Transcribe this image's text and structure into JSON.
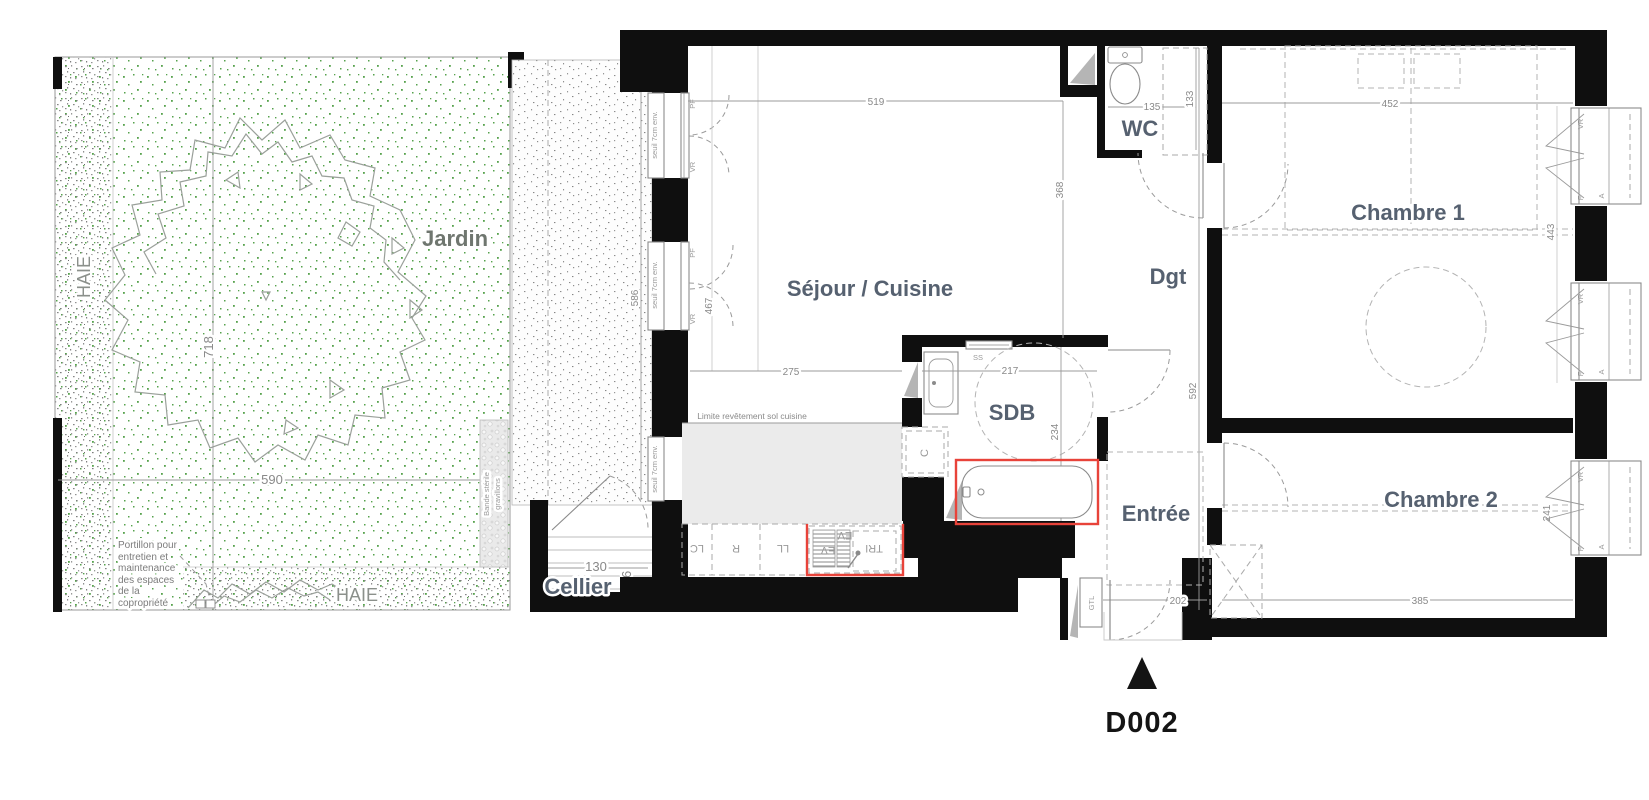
{
  "colors": {
    "wall": "#0f0f0f",
    "red_highlight": "#e8433a",
    "room_label": "#566170",
    "outdoor_label": "#6f766f",
    "dim_text": "#898989",
    "garden_dot_green": "#56a24c",
    "kitchen_floor": "#ebebeb",
    "marker": "#141414"
  },
  "garden": {
    "label": "Jardin",
    "hedge_left": "HAIE",
    "hedge_bottom": "HAIE",
    "dim_height": "718",
    "dim_width": "590",
    "sterile_line1": "Bande stérile",
    "sterile_line2": "gravillons",
    "gate_note_lines": [
      "Portillon pour",
      "entretien et",
      "maintenance",
      "des espaces",
      "de la",
      "copropriété"
    ]
  },
  "exterior": {
    "terrace_dim": "586",
    "threshold_note": "seuil 7cm env.",
    "entrance_marker": "D002"
  },
  "windows": {
    "pf": "PF",
    "vr": "VR",
    "f": "F",
    "a": "A"
  },
  "rooms": {
    "living": {
      "label": "Séjour / Cuisine",
      "dim_width": "519",
      "dim_height": "368",
      "dim_kitchen": "275",
      "dim_window": "467",
      "floor_note": "Limite revêtement sol cuisine"
    },
    "kitchen_units": {
      "lc": "LC",
      "r": "R",
      "ll": "LL",
      "ev": "EV",
      "tri": "TRI"
    },
    "cellar": {
      "label": "Cellier",
      "dim_width": "130",
      "dim_height": "96"
    },
    "wc": {
      "label": "WC",
      "dim_width": "135",
      "dim_height": "133"
    },
    "bathroom": {
      "label": "SDB",
      "towel_rail": "SS",
      "column": "C",
      "dim_width": "217",
      "dim_height": "234"
    },
    "hallway": {
      "label": "Dgt"
    },
    "entry": {
      "label": "Entrée",
      "duct": "GTL",
      "dim_width": "202",
      "dim_height": "592"
    },
    "bedroom1": {
      "label": "Chambre 1",
      "dim_width": "452",
      "dim_window": "443"
    },
    "bedroom2": {
      "label": "Chambre 2",
      "dim_width": "385",
      "dim_window": "241"
    }
  }
}
